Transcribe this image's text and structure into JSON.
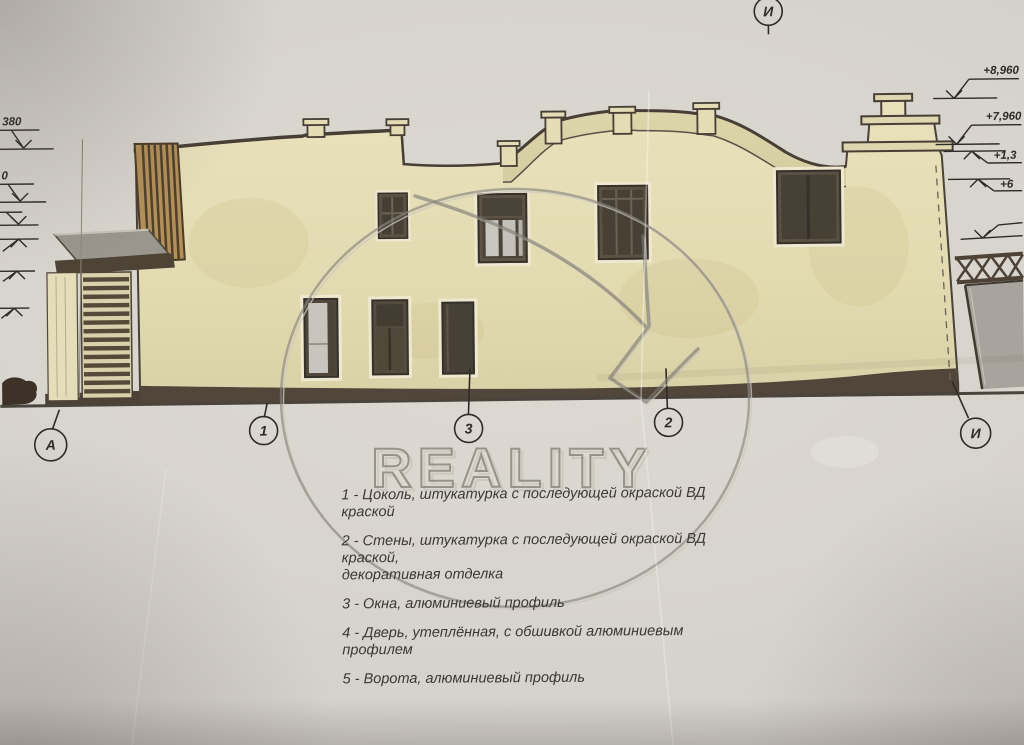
{
  "document": {
    "kind": "building elevation drawing photo",
    "watermark": {
      "brand": "REALITY"
    }
  },
  "axis_markers": {
    "top": "И",
    "bottom": [
      "А",
      "1",
      "3",
      "2",
      "И"
    ]
  },
  "elevation_marks": {
    "right": [
      "+8,960",
      "+7,960",
      "+1,3",
      "+6"
    ],
    "left": [
      "380",
      "0"
    ]
  },
  "legend": {
    "items": [
      "1 - Цоколь, штукатурка с последующей окраской ВД краской",
      "2 - Стены, штукатурка с последующей окраской ВД краской,\nдекоративная отделка",
      "3 - Окна, алюминиевый профиль",
      "4 - Дверь, утеплённая, с обшивкой алюминиевым профилем",
      "5 - Ворота, алюминиевый профиль"
    ]
  },
  "colors": {
    "paper": "#d6d2cc",
    "wall": "#e5deb6",
    "wall_shade": "#d9d1a6",
    "outline": "#4a4238",
    "plinth": "#51463a",
    "wood": "#b3905a",
    "canopy_glass": "#9b968d",
    "gate_gray": "#a8a49d",
    "watermark_gray": "#817d75"
  }
}
